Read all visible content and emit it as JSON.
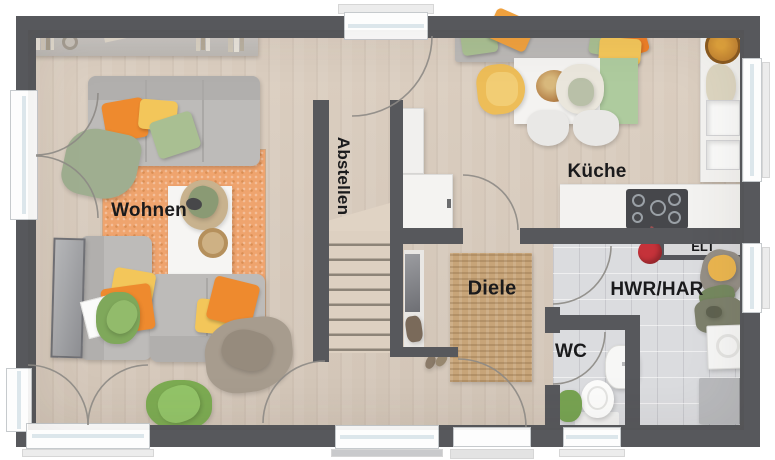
{
  "type": "floor-plan",
  "rooms": {
    "wohnen": {
      "label": "Wohnen"
    },
    "abstellen": {
      "label": "Abstellen"
    },
    "kueche": {
      "label": "Küche"
    },
    "diele": {
      "label": "Diele"
    },
    "wc": {
      "label": "WC"
    },
    "hwr": {
      "label": "HWR/HAR"
    },
    "elt": {
      "label": "ELT"
    }
  },
  "colors": {
    "wall": "#57585c",
    "floor_wood": "#d7cabc",
    "floor_tile": "#dbdcdf",
    "rug_orange": "#efa46e",
    "rug_jute": "#c7a478",
    "sofa_gray": "#bdbbb9",
    "pillow_orange": "#ee8a2e",
    "pillow_yellow": "#f3c65a",
    "pillow_green": "#a9bf92",
    "counter_white": "#f3f2f0",
    "label_text": "#1a1a1c"
  }
}
